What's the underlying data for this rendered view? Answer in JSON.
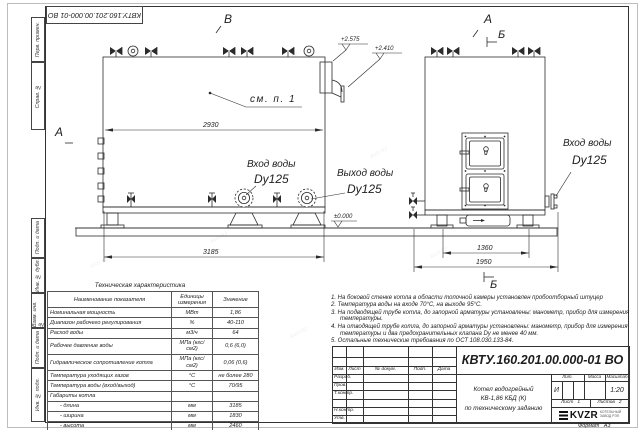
{
  "sheet": {
    "stamp_rotated": "КВТУ.160.201.00.000-01 ВО",
    "format_label": "Формат",
    "format_value": "А3",
    "frame_labels_top": [
      "Перв. примен.",
      "Справ. №"
    ],
    "frame_labels_bottom": [
      "Подп. и дата",
      "Инв. № дубл.",
      "Взам. инв. №",
      "Подп. и дата",
      "Инв. № подл."
    ],
    "watermark": "kvzr.kz"
  },
  "annotations": {
    "marker_a": "А",
    "marker_b": "Б",
    "marker_v": "В",
    "see_note": "см. п. 1",
    "water_inlet": "Вход воды",
    "water_outlet": "Выход воды",
    "dn125": "Dy125",
    "dim_2930": "2930",
    "dim_3185": "3185",
    "dim_1360": "1360",
    "dim_1950": "1950",
    "elev_2575": "+2.575",
    "elev_2410": "+2.410",
    "elev_zero": "±0.000"
  },
  "tech_table": {
    "title": "Техническая характеристика",
    "headers": [
      "Наименование показателя",
      "Единицы измерения",
      "Значение"
    ],
    "rows": [
      [
        "Номинальная мощность",
        "МВт",
        "1,86"
      ],
      [
        "Диапазон рабочего регулирования",
        "%",
        "40-110"
      ],
      [
        "Расход воды",
        "м3/ч",
        "64"
      ],
      [
        "Рабочее давление воды",
        "МПа (кгс/см2)",
        "0,6 (6,0)"
      ],
      [
        "Гидравлическое сопротивление котла",
        "МПа (кгс/см2)",
        "0,06 (0,6)"
      ],
      [
        "Температура уходящих газов",
        "°С",
        "не более 280"
      ],
      [
        "Температура воды (вход/выход)",
        "°С",
        "70/95"
      ],
      [
        "Габариты котла",
        "",
        ""
      ],
      [
        "- длина",
        "мм",
        "3185"
      ],
      [
        "- ширина",
        "мм",
        "1830"
      ],
      [
        "- высота",
        "мм",
        "2460"
      ]
    ]
  },
  "notes": [
    "1. На боковой стенке котла в области топочной камеры установлен пробоотборный штуцер",
    "2. Температура воды на входе 70°С, на выходе 95°С.",
    "3. На подводящей трубе котла, до запорной арматуры установлены: манометр, прибор для измерения температуры.",
    "4. На отводящей трубе котла, до запорной арматуры установлены: манометр, прибор для измерения температуры и два предохранительных клапана Dy не менее 40 мм.",
    "5. Остальные технические требования по ОСТ 108.030.133-84."
  ],
  "title_block": {
    "designation": "КВТУ.160.201.00.000-01 ВО",
    "name_line1": "Котел водогрейный",
    "name_line2": "КВ-1,86 КБД (К)",
    "name_line3": "по техническому заданию",
    "col_izm": "Изм.",
    "col_list": "Лист",
    "col_ndoc": "№ докум.",
    "col_podp": "Подп.",
    "col_data": "Дата",
    "row_razrab": "Разраб.",
    "row_prov": "Пров.",
    "row_tkontr": "Т.контр.",
    "row_nkontr": "Н.контр.",
    "row_utv": "Утв.",
    "lit_header": "Лит.",
    "mass_header": "Масса",
    "scale_header": "Масштаб",
    "lit_value": "И",
    "scale_value": "1:20",
    "sheet_label": "Лист",
    "sheet_value": "1",
    "sheets_label": "Листов",
    "sheets_value": "2",
    "logo_text": "KVZR",
    "company_line1": "КОТЕЛЬНЫЙ",
    "company_line2": "ЗАВОД РЭП"
  }
}
